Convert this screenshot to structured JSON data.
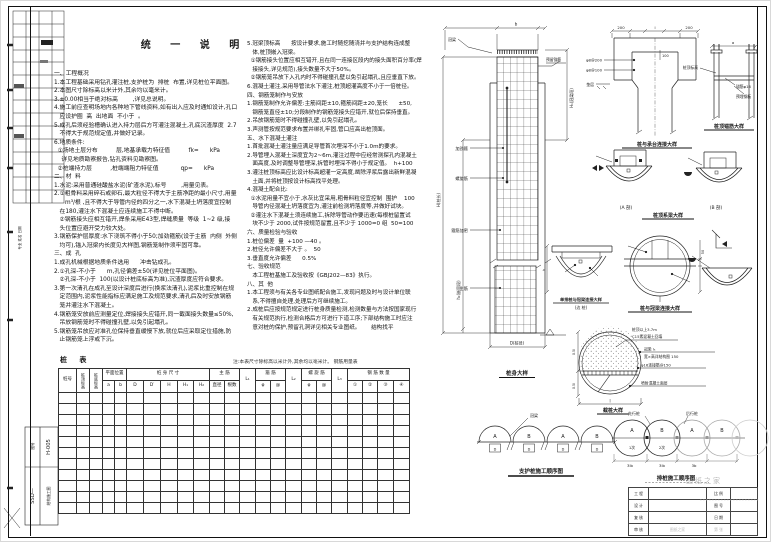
{
  "sheet": {
    "main_title": "统 一 说 明",
    "watermark": "图纸之家",
    "corner_code_top": "H-005",
    "corner_code_side": "SSD—",
    "corner_code_label": "结构施工图",
    "corner_code_small": "图号",
    "side_strip_label": "专业  姓名  日期"
  },
  "notes_left": [
    "一、工程概况",
    "1.本工程基础采用钻孔灌注桩,支护桩为  排桩  布置,详见桩位平面图。",
    "2.本图尺寸除标高以米计外,其余均以毫米计。",
    "3.±0.00相当于绝对标高        ,详见总说明。",
    "4.施工前应查明场地内各种地下管线资料,如有出入应及时通知设计,孔口",
    "   应设护圈  高  出地面  不小于  。",
    "5.成孔后须经验槽确认进入持力层后方可灌注混凝土,孔底沉渣厚度  2.7",
    "   不得大于规范规定值,并做好记录。",
    "6.地质条件:",
    "  ①场地土层分布          层,地基承载力特征值          fk=      kPa",
    "    详见地质勘察报告,钻孔资料见勘察图。",
    "  ②桩端持力层          ,桩端端阻力特征值            qp=      kPa",
    "二、材  料",
    "1.水泥:采用普通硅酸盐水泥(矿渣水泥),标号        ,用量见表。",
    "2.①粗骨料采用碎石或卵石,最大粒径不得大于主筋净距的最小尺寸,用量",
    "      m³/根 ,且不得大于导管内径的四分之一,水下混凝土坍落度宜控制",
    "   在180,灌注水下混凝土应连续施工不得中断。",
    "   ②钢筋接头应相互错开,焊条采用E43型,焊缝质量  等级  1~2 级,接",
    "   头位置应避开受力较大处。",
    "3.钢筋保护层厚度:水下浇筑不得小于50;加劲箍筋(设于主筋  内侧  外侧",
    "   均可),锚入冠梁内长度见大样图,钢筋笼制作须牢固可靠。",
    "三、成  孔",
    "1.成孔机械根据地质条件选用      冲击钻成孔。",
    "2.①孔深-不小于      m,孔径偏差±50(详见桩位平面图)。",
    "   ②孔深-不小于  100(以设计桩底标高为准),沉渣厚度应符合要求。",
    "3.第一次清孔在成孔至设计深度后进行(换浆法清孔),泥浆比重控制在规",
    "   定范围内,泥浆性能指标应满足施工及规范要求,清孔后及时安放钢筋",
    "   笼并灌注水下混凝土。",
    "4.钢筋笼安放前应测量定位,焊接接头应错开,同一截面接头数量≤50%,",
    "   吊放钢筋笼时不得碰撞孔壁,以免引起塌孔。",
    "5.钢筋笼吊放应对准孔位保持垂直缓慢下放,就位后应采取定位措施,防",
    "   止钢筋笼上浮或下沉。"
  ],
  "notes_right": [
    "5.冠梁顶标高      按设计要求,施工时随挖随浇并与支护结构连成整",
    "   体,桩顶嵌入冠梁。",
    "  ①钢筋接头位置应相互错开,且在同一连接区段内的接头面积百分率(焊",
    "   接接头,详见规范),接头数量不大于50%。",
    "  ②钢筋笼吊放下入孔内时不得碰撞孔壁以免引起塌孔,且应垂直下放。",
    "6.混凝土灌注,采用导管法水下灌注,桩顶超灌高度不小于一倍桩径。",
    "四、钢筋笼制作与安放",
    "1.钢筋笼制作允许偏差:主筋间距±10,箍筋间距±20,笼长      ±50,",
    "   钢筋笼直径±10;分段制作的钢筋笼接头应错开,就位后保持垂直。",
    "2.吊放钢筋笼时不得碰撞孔壁,以免引起塌孔。",
    "3.声测管按规范要求布置并绑扎牢固,管口应高出桩顶面。",
    "五、水下混凝土灌注",
    "1.首批混凝土灌注量应满足导管首次埋深不小于1.0m的要求。",
    "2.导管埋入混凝土深度宜为2~6m,灌注过程中应经常测探孔内混凝土",
    "   面高度,及时调整导管埋深,拆管时埋深不得小于规定值。  h+100",
    "3.灌注桩顶标高应比设计标高超灌一定高度,凿除浮浆后露出新鲜混凝",
    "   土面,并将桩顶按设计标高找平处理。",
    "4.混凝土配合比:",
    "  ①水泥用量不宜小于,水灰比宜采用,粗骨料粒径宜控制  围护    100",
    "   导管内径混凝土坍落度宜为,灌注前检测坍落度等,并做好试块。",
    "  ②灌注水下混凝土须连续施工,拆除导管动作要迅速(每根桩留置试",
    "   块不少于 2000,试件按规范留置,且不少于 1000=0 组  50=100",
    "六、质量检验与验收",
    "1.桩位偏差  量  +100 —40 。",
    "2.桩径允许偏差不大于 。  50",
    "3.垂直度允许偏差      0.5%",
    "七、验收规范",
    "   本工程桩基施工及验收按《GBJ202—83》执行。",
    "八、其  他",
    "1.本工程须与有关各专业图纸配合施工,发现问题及时与设计单位联",
    "   系,不得擅自处理,处理后方可继续施工。",
    "2.成桩后应按规范规定进行桩身质量检测,检测数量与方法按国家现行",
    "   有关规范执行,检测合格后方可进行下道工序;下部结构施工时应注",
    "   意对桩的保护,预留孔洞详见相关专业图纸。      结构找平"
  ],
  "pile_table": {
    "title": "桩  表",
    "note": "注:本表尺寸除标高以米计外,其余均以毫米计。      钢筋用量表",
    "h1": [
      "桩号",
      "桩顶标高",
      "桩底标高",
      "平面位置",
      "桩 身 尺 寸",
      "主  筋",
      "L₁",
      "箍  筋",
      "L₂",
      "螺 旋 筋",
      "L₃",
      "钢 筋 数 量"
    ],
    "h2": [
      "a",
      "b",
      "D",
      "D′",
      "H",
      "H₁",
      "H₂",
      "直径",
      "根数",
      "φ",
      "@",
      "φ",
      "@",
      "①",
      "②",
      "③",
      "④"
    ],
    "empty_rows": 11
  },
  "drawings": {
    "pile": {
      "title": "桩身大样",
      "top_label": "冠梁",
      "top_dim": "b",
      "anchor_label": "预留锚筋",
      "lead1": "加劲箍",
      "lead2": "螺旋筋",
      "lead3": "箍筋加密",
      "lead4": "主筋",
      "dim_h": "H(桩长)",
      "dim_h2": "h₁(嵌固段)",
      "dim_right": "H₁(冠梁段)",
      "dim_d": "D(桩径)"
    },
    "cap": {
      "title": "桩与承台连接大样",
      "d1": "200",
      "d2": "l",
      "d3": "200",
      "l1": "φ8@200",
      "l2": "φ8@100",
      "inner": "100",
      "ground": "垫层"
    },
    "anchor": {
      "title": "桩顶锚筋大样",
      "dim": "a",
      "l1": "锚筋φ16",
      "l2": "预埋钢板",
      "left": "桩顶标高"
    },
    "sa": "(A 剖)",
    "sb": "(B 剖)",
    "sections_title": "桩顶系梁大样",
    "ring": {
      "title": "桩与冠梁连接大样",
      "dim1": "50",
      "dim2": "400"
    },
    "half": {
      "title1": "单排桩与冠梁连接大样",
      "title2": "(边 桩)",
      "dim": "h"
    },
    "cut": {
      "title": "截桩大样",
      "t1": "桩顶以上3.7m",
      "t2": "C15素混凝土回填",
      "r1": "冠梁  l₅",
      "r2": "宽×高详结构图  150",
      "r3": "φ16连接筋@150",
      "r4": "喷射混凝土面层",
      "dl1": "0.5l",
      "dl2": "0.5l",
      "db": "l"
    },
    "seq_small": {
      "a": "A",
      "b": "B",
      "leader": "冠梁",
      "dim": "D",
      "title": "支护桩施工顺序图"
    },
    "seq_large": {
      "a": "A",
      "b": "B",
      "s1": "1次",
      "s2": "2次",
      "lead1": "先行桩",
      "lead2": "后行桩",
      "d1": "3lb",
      "d2": "3lb",
      "d3": "3b",
      "title": "排桩施工顺序图"
    }
  },
  "titleblock": {
    "r1c1": "工 程",
    "r1c3": "比 例",
    "r2c1": "设 计",
    "r2c3": "图 号",
    "r3c1": "复 核",
    "r3c3": "日 期",
    "r4c1": "审 核",
    "r4c2": "图纸之家",
    "r4c3": "第  张"
  }
}
